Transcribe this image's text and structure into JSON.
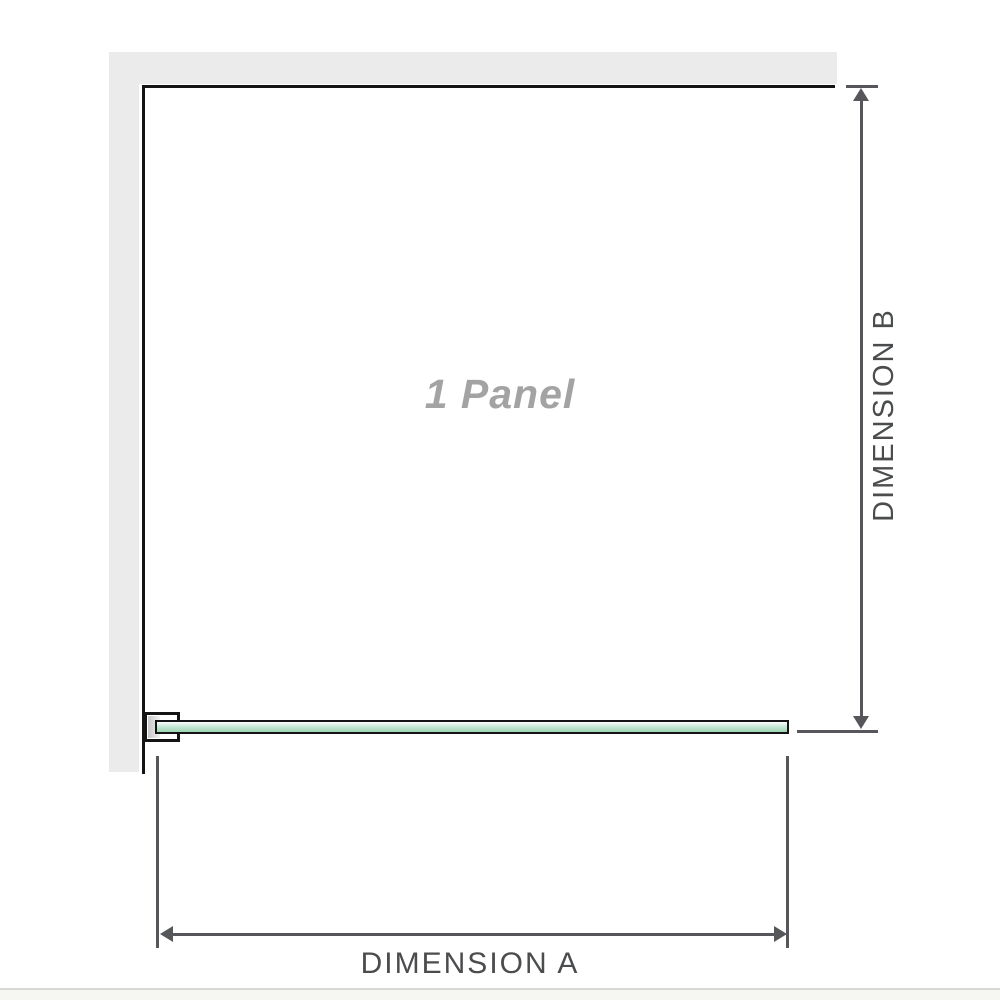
{
  "diagram": {
    "panel_label": "1 Panel",
    "dimensions": {
      "a_label": "DIMENSION A",
      "b_label": "DIMENSION B"
    },
    "icons": {
      "dim_b_top": "arrow-up-icon",
      "dim_b_bottom": "arrow-down-icon",
      "dim_a_left": "arrow-left-icon",
      "dim_a_right": "arrow-right-icon"
    },
    "colors": {
      "background": "#ffffff",
      "wall_fill": "#ebebeb",
      "panel_outline": "#141414",
      "glass_fill": "#b9e3ca",
      "glass_border": "#141414",
      "bracket_fill": "#ffffff",
      "dimension_line": "#55575a",
      "dimension_text": "#4a4c4e",
      "panel_label_text": "#a3a3a3",
      "footer_line": "#d8d8d4"
    }
  }
}
